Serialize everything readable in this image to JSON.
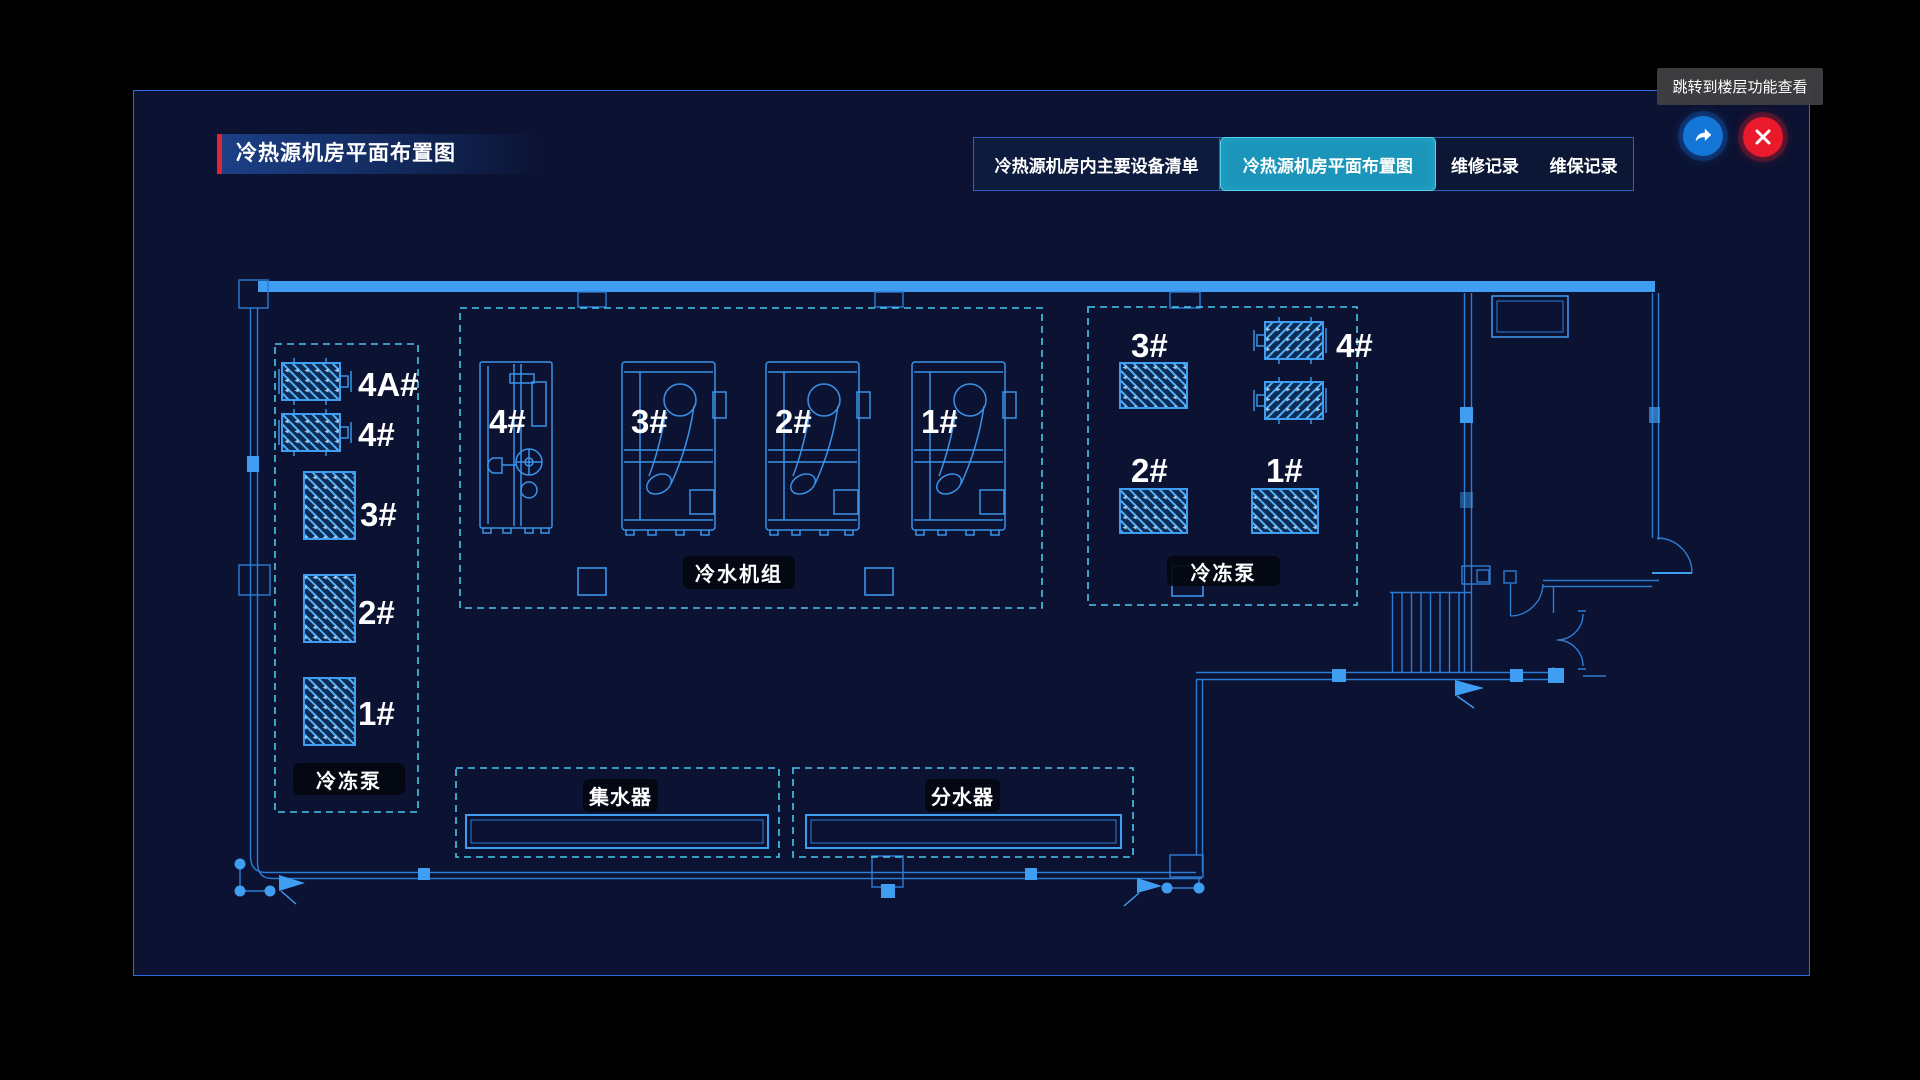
{
  "header": {
    "title": "冷热源机房平面布置图",
    "tooltip": "跳转到楼层功能查看"
  },
  "tabs": [
    {
      "label": "冷热源机房内主要设备清单",
      "active": false
    },
    {
      "label": "冷热源机房平面布置图",
      "active": true
    },
    {
      "label": "维修记录",
      "active": false
    },
    {
      "label": "维保记录",
      "active": false
    }
  ],
  "plan": {
    "left_pumps": {
      "name": "冷冻泵",
      "units": [
        "4A#",
        "4#",
        "3#",
        "2#",
        "1#"
      ]
    },
    "chillers": {
      "name": "冷水机组",
      "units": [
        "4#",
        "3#",
        "2#",
        "1#"
      ]
    },
    "right_pumps": {
      "name": "冷冻泵",
      "units": [
        "3#",
        "4#",
        "2#",
        "1#"
      ]
    },
    "collector": {
      "name": "集水器"
    },
    "distributor": {
      "name": "分水器"
    }
  },
  "colors": {
    "panel_bg": "#0b1232",
    "panel_border": "#2d6be0",
    "wall_bright": "#3f9ef2",
    "line_blue": "#2e7cd2",
    "dashed_cyan": "#46c8ec",
    "active_tab_bg": "#1b96ba",
    "active_tab_border": "#4ed2ee",
    "title_red": "#e02531",
    "jump_button_blue": "#1477d8",
    "close_button_red": "#ea1a2c"
  }
}
